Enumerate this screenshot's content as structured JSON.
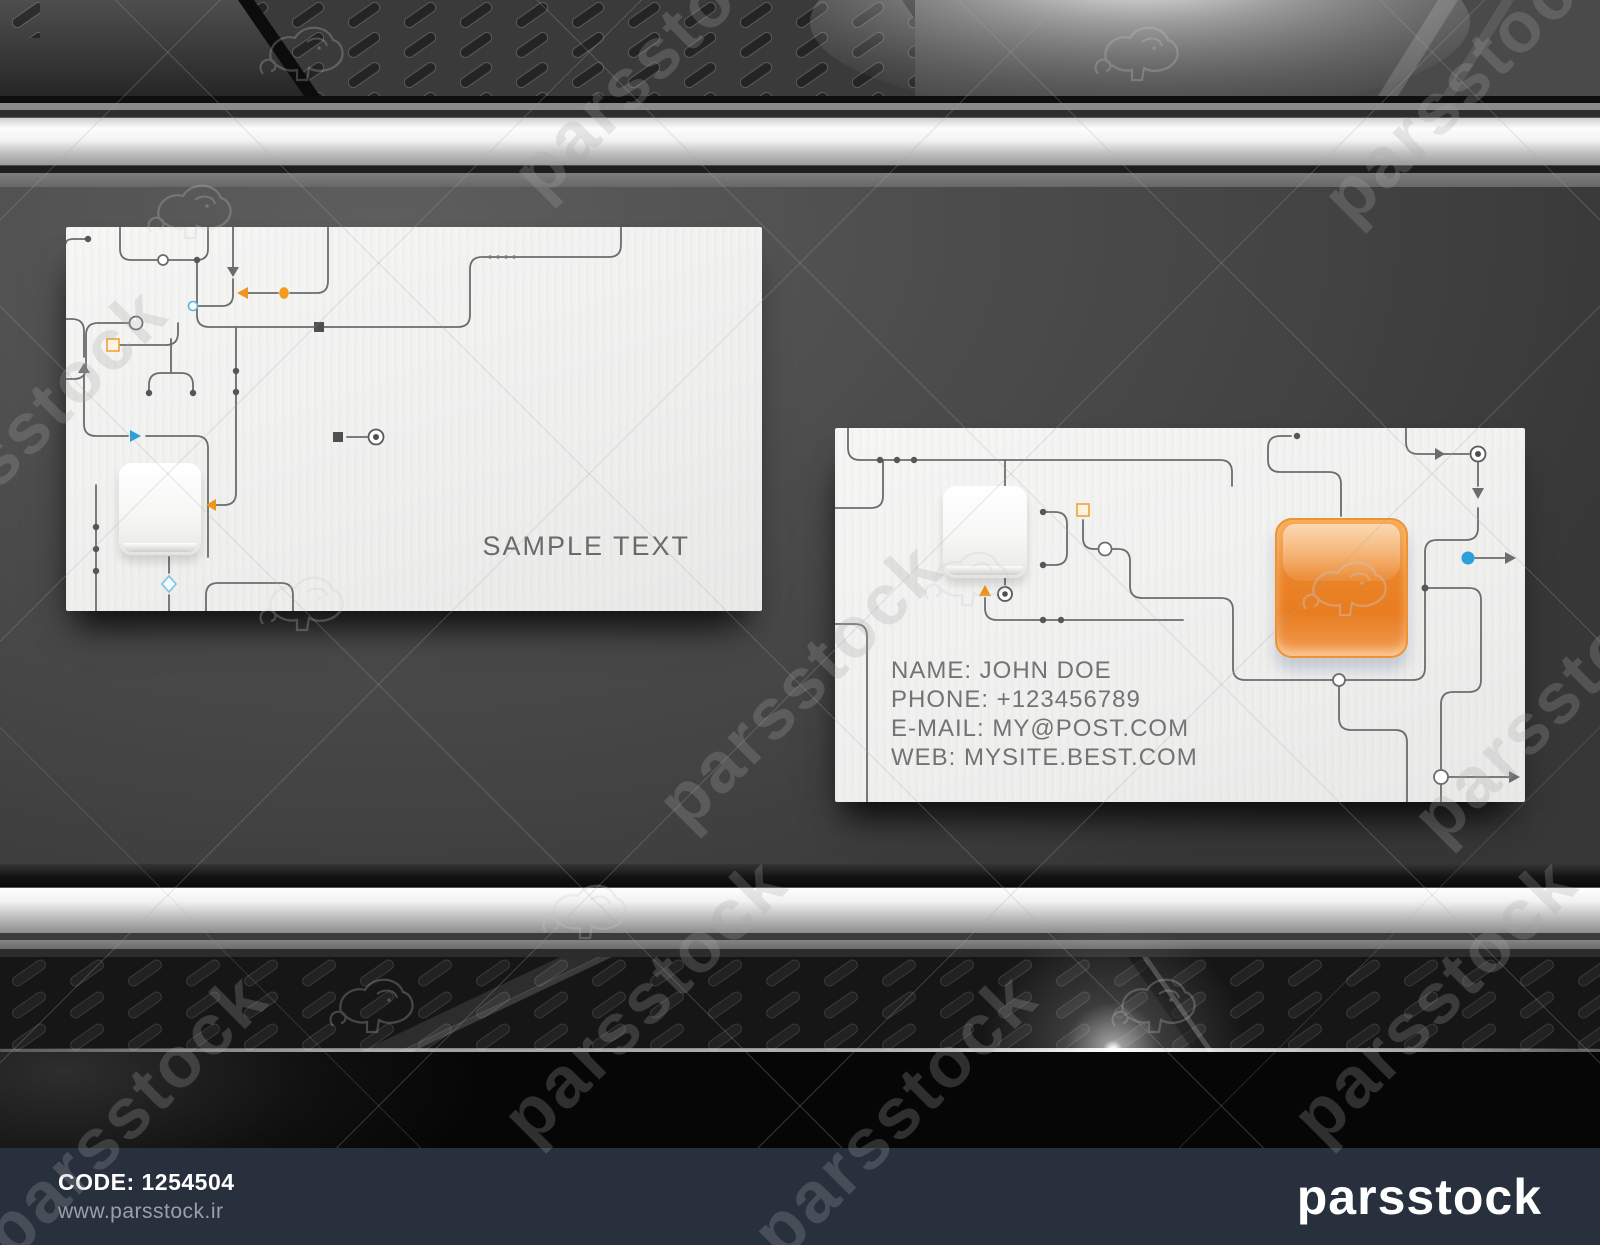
{
  "footer": {
    "code": "CODE: 1254504",
    "website": "www.parsstock.ir",
    "logo": "parsstock"
  },
  "watermark": {
    "text": "parsstock"
  },
  "cards": {
    "front": {
      "sample_text": "SAMPLE TEXT"
    },
    "back": {
      "lines": [
        "NAME: JOHN DOE",
        "PHONE: +123456789",
        "E-MAIL: MY@POST.COM",
        "WEB: MYSITE.BEST.COM"
      ]
    }
  },
  "colors": {
    "accent_orange": "#ed861f",
    "accent_blue": "#2d9ed8",
    "trace_gray": "#6c6c6c",
    "footer_bg": "#27303c",
    "card_bg": "#f2f2f1"
  }
}
